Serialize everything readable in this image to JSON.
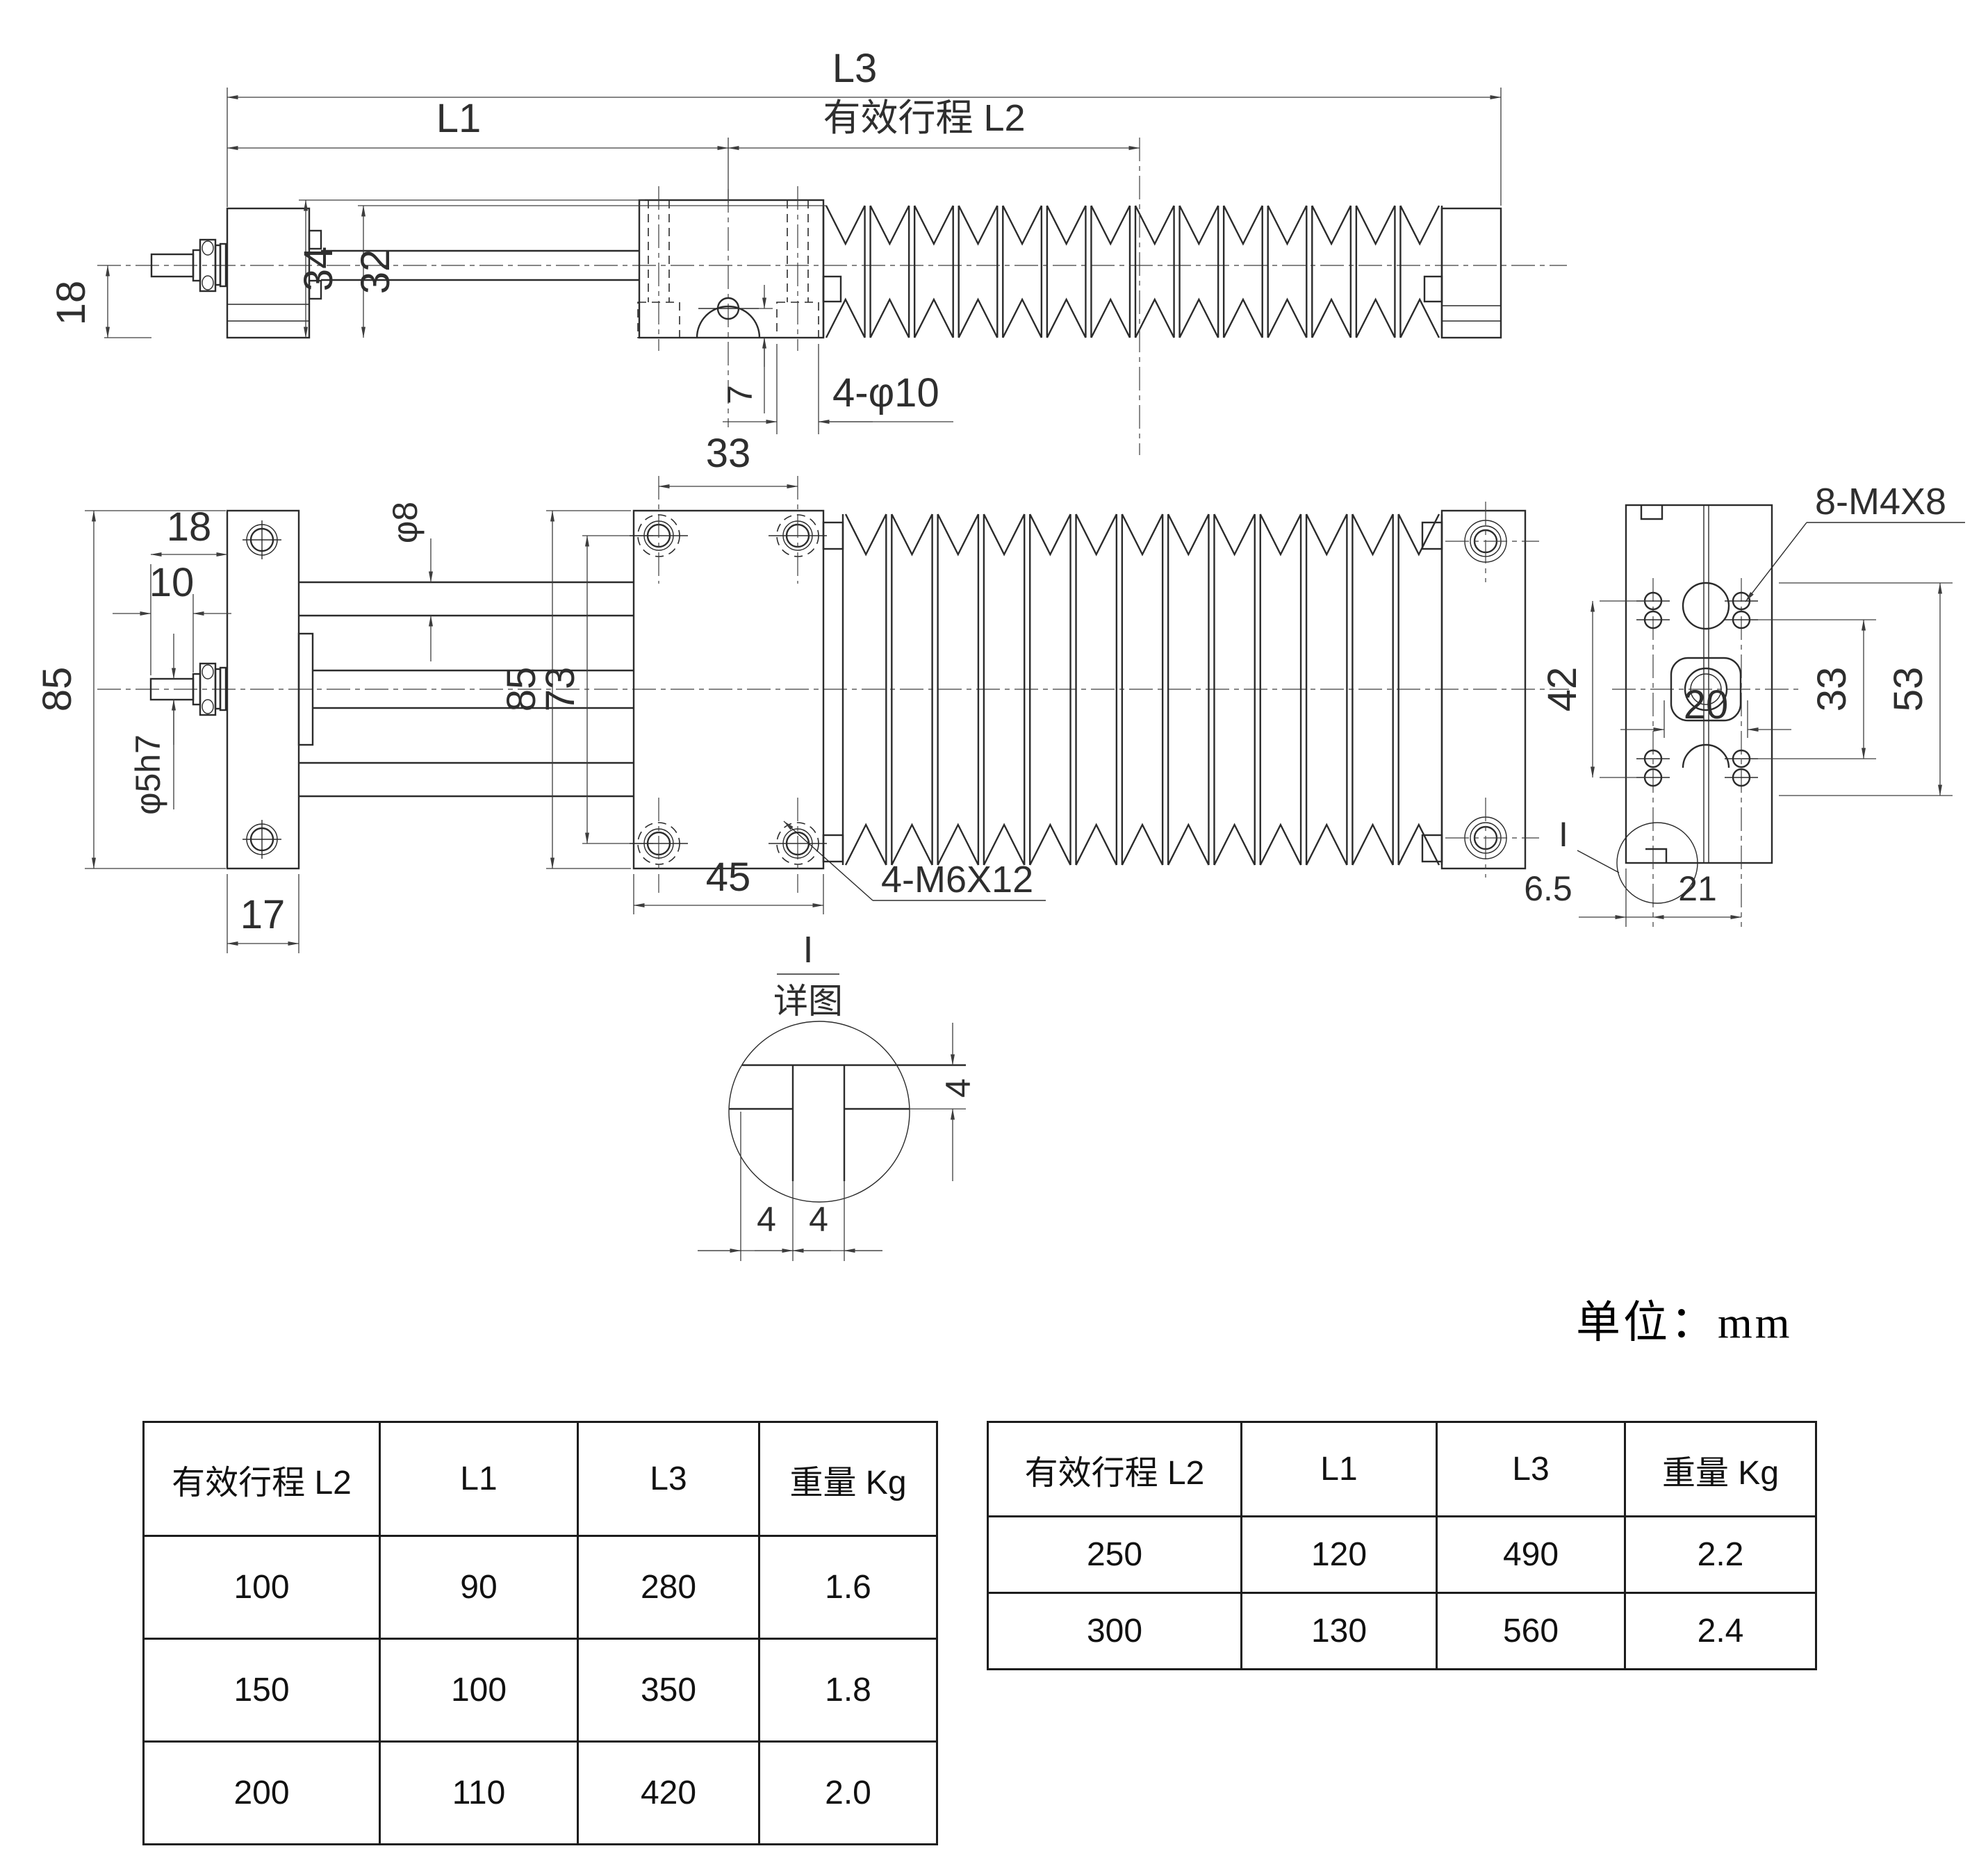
{
  "unit_note": "单位：mm",
  "side_view": {
    "l3": "L3",
    "l1": "L1",
    "l2": "有效行程 L2",
    "height_18": "18",
    "height_34": "34",
    "height_32": "32",
    "offset_7": "7",
    "holes_label": "4-φ10"
  },
  "plan_view": {
    "width_18": "18",
    "width_10": "10",
    "shaft_dia": "φ5h7",
    "plate_height_85": "85",
    "body_height_85": "85",
    "hole_span_73": "73",
    "hole_span_33": "33",
    "plate_width_17": "17",
    "table_width_45": "45",
    "rod_dia": "φ8",
    "screw_label": "4-M6X12"
  },
  "end_view": {
    "span_42": "42",
    "span_33": "33",
    "span_53": "53",
    "width_20": "20",
    "edge_6_5": "6.5",
    "span_21": "21",
    "screw_label": "8-M4X8",
    "detail_ref": "I"
  },
  "detail_view": {
    "ref": "I",
    "title": "详图",
    "depth_4": "4",
    "left_4": "4",
    "right_4": "4"
  },
  "tables": {
    "headers": [
      "有效行程 L2",
      "L1",
      "L3",
      "重量 Kg"
    ],
    "left": {
      "rows": [
        [
          "100",
          "90",
          "280",
          "1.6"
        ],
        [
          "150",
          "100",
          "350",
          "1.8"
        ],
        [
          "200",
          "110",
          "420",
          "2.0"
        ]
      ]
    },
    "right": {
      "rows": [
        [
          "250",
          "120",
          "490",
          "2.2"
        ],
        [
          "300",
          "130",
          "560",
          "2.4"
        ]
      ]
    }
  }
}
